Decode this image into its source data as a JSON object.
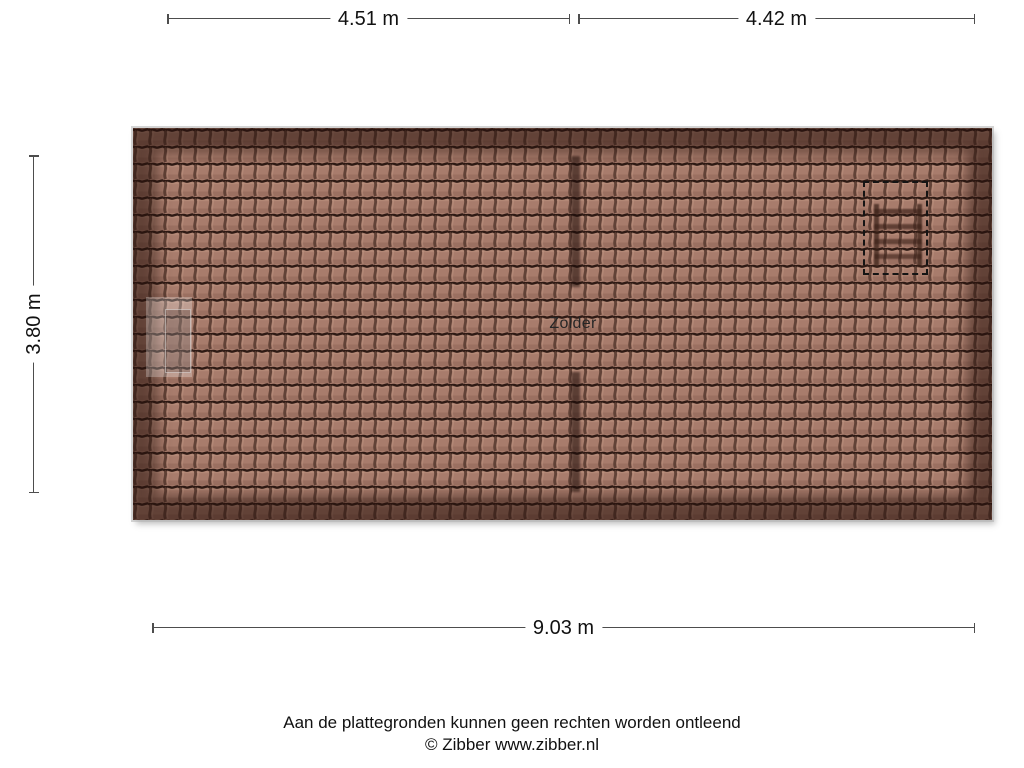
{
  "floorplan": {
    "room_label": "Zolder"
  },
  "dimensions": {
    "top_left": "4.51 m",
    "top_right": "4.42 m",
    "left_side": "3.80 m",
    "bottom": "9.03 m"
  },
  "footer": {
    "disclaimer": "Aan de plattegronden kunnen geen rechten worden ontleend",
    "copyright": "© Zibber www.zibber.nl"
  },
  "icons": {
    "loft_ladder": "loft-ladder-icon",
    "attic_hatch": "dashed-hatch-outline"
  },
  "colors": {
    "background": "#ffffff",
    "roof_tile": "#a87c6c",
    "roof_tile_gap": "#2e1a14",
    "roof_ridge_shadow": "#5a3c31",
    "roof_edge_shadow": "#2a120c",
    "dimension_line": "#4d4d4d",
    "text": "#111111"
  }
}
